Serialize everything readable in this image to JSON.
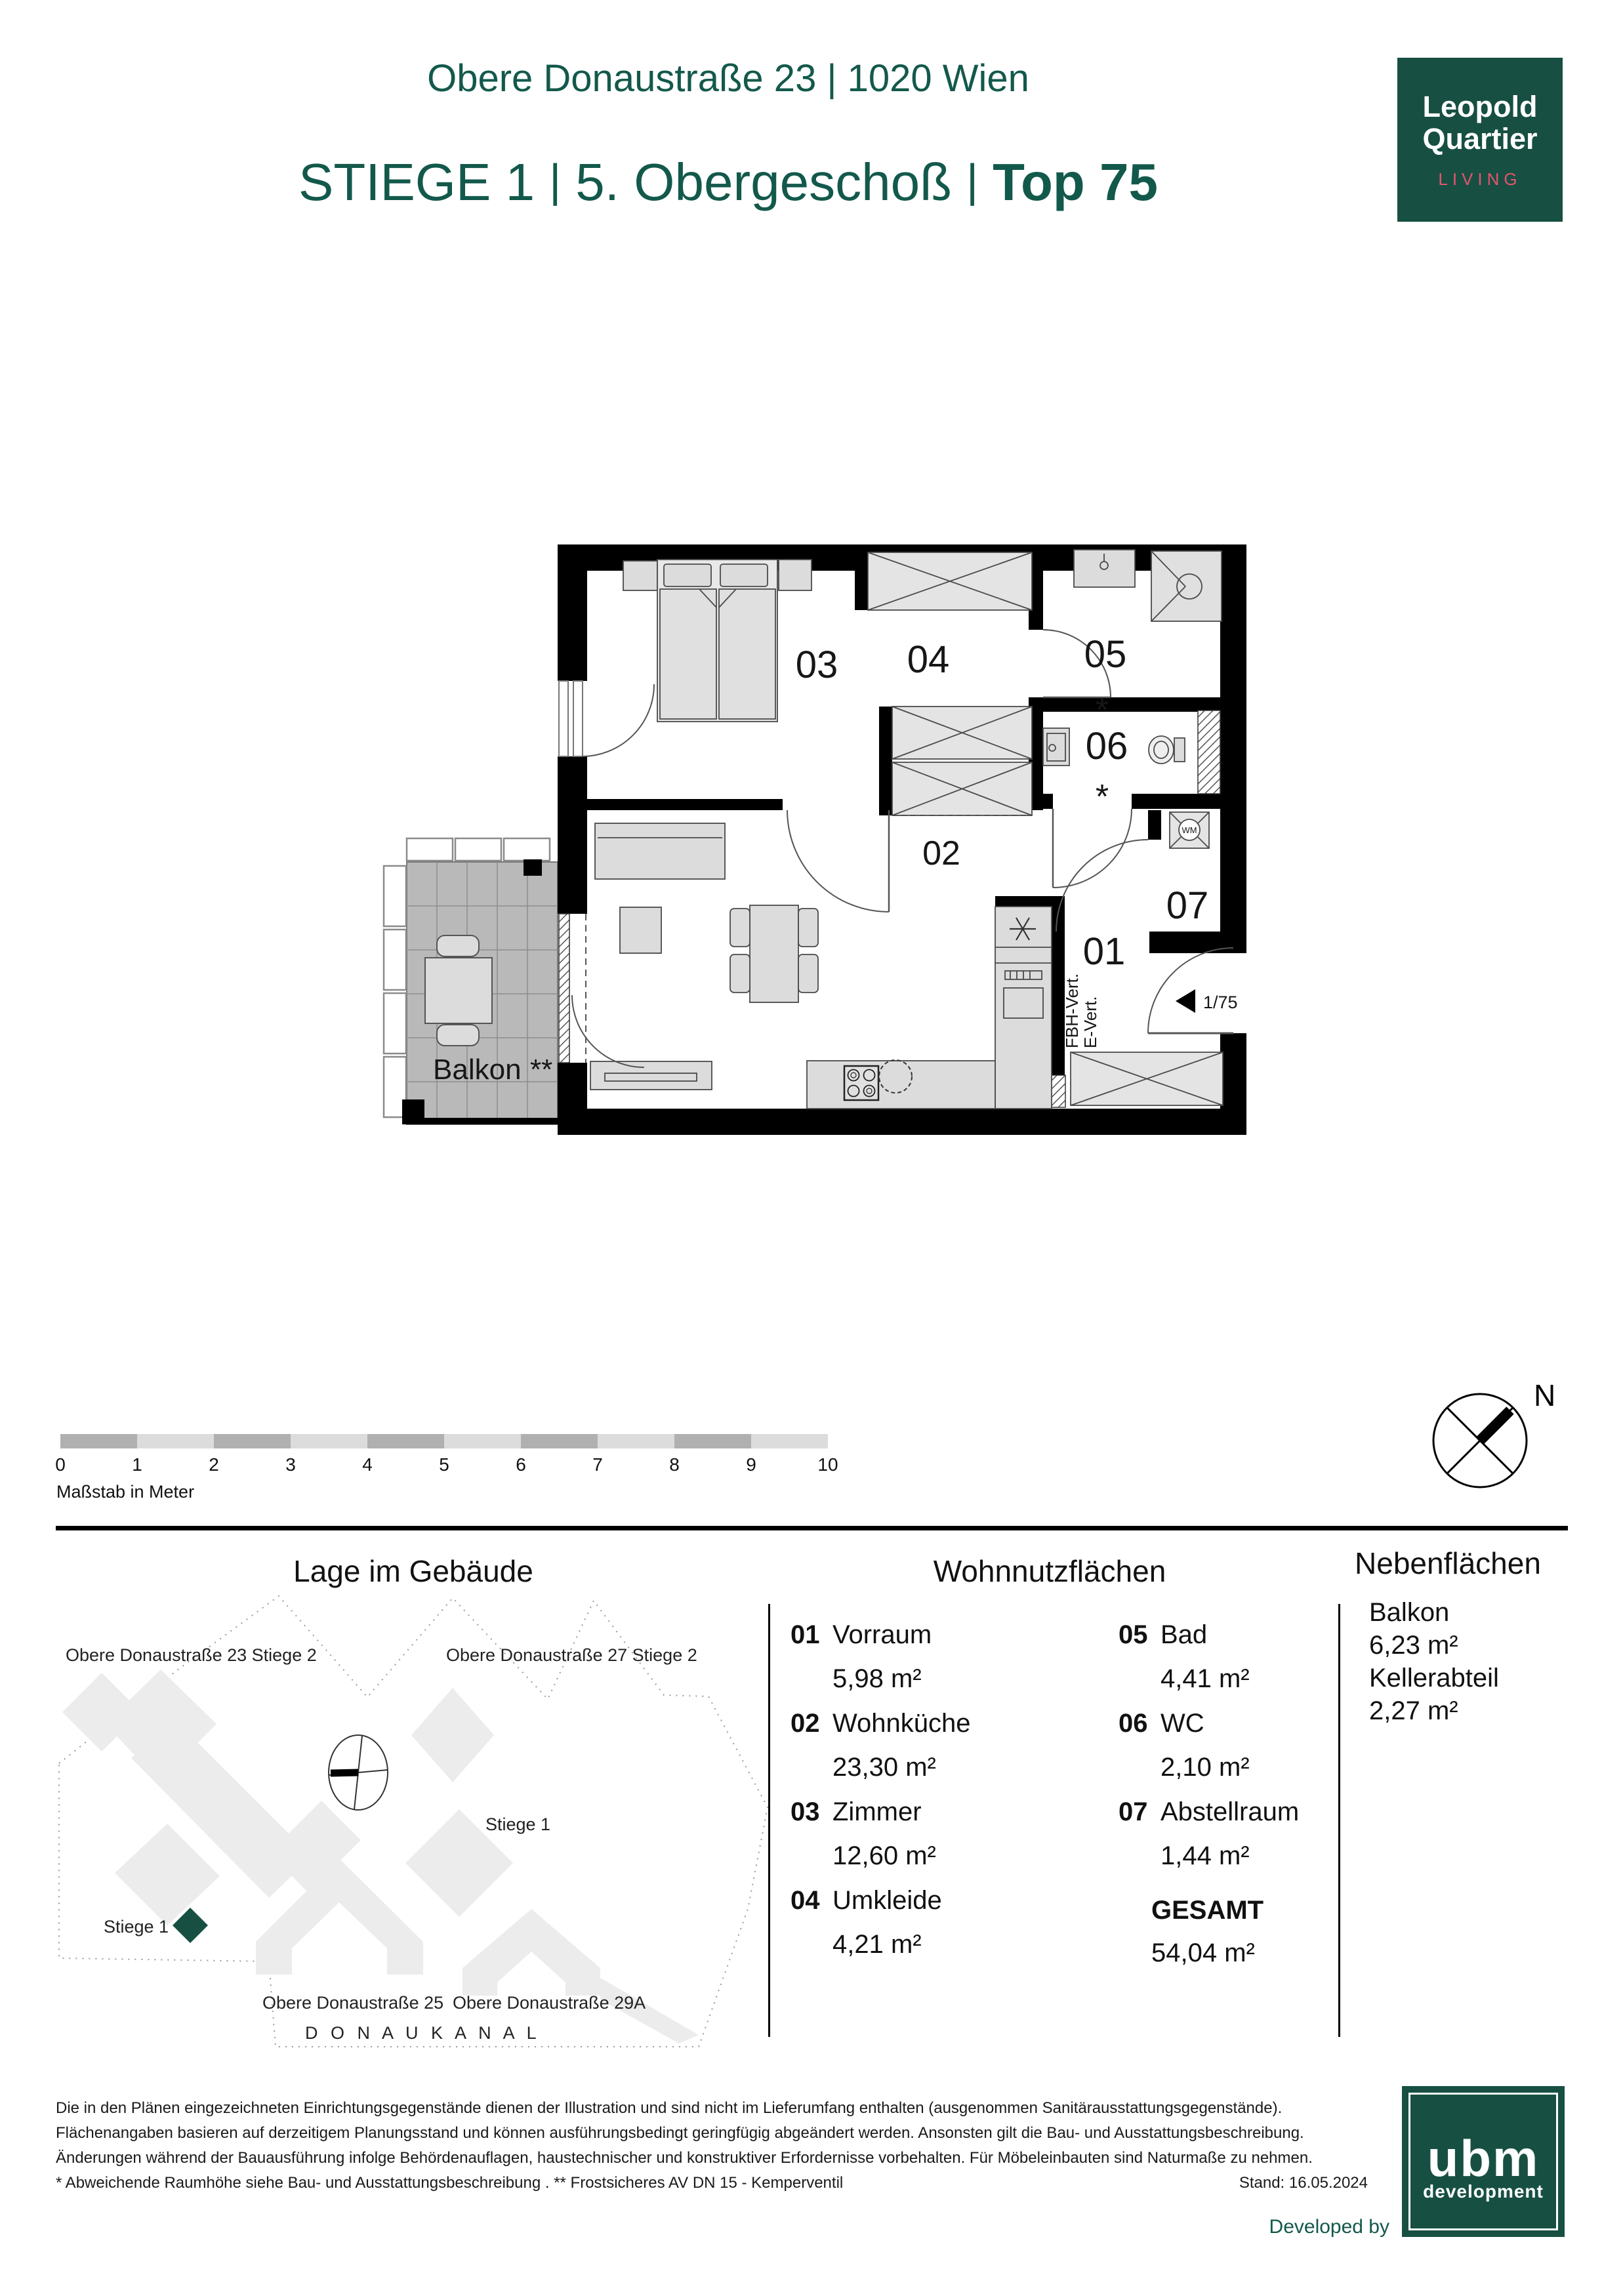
{
  "header": {
    "address": "Obere Donaustraße 23 | 1020 Wien",
    "stiege": "STIEGE 1",
    "sep": "|",
    "floor": "5. Obergeschoß",
    "top": "Top 75"
  },
  "brand": {
    "line1": "Leopold",
    "line2": "Quartier",
    "line3": "LIVING"
  },
  "floor_plan": {
    "rooms": {
      "r01": "01",
      "r02": "02",
      "r03": "03",
      "r04": "04",
      "r05": "05",
      "r06": "06",
      "r07": "07"
    },
    "star": "*",
    "balkon": "Balkon",
    "balkon_note": "**",
    "wm": "WM",
    "fbh": "FBH-Vert.",
    "evert": "E-Vert.",
    "entry_door": "1/75"
  },
  "scalebar": {
    "ticks": [
      "0",
      "1",
      "2",
      "3",
      "4",
      "5",
      "6",
      "7",
      "8",
      "9",
      "10"
    ],
    "label": "Maßstab in Meter"
  },
  "compass": {
    "north": "N"
  },
  "site_plan": {
    "title": "Lage im Gebäude",
    "labels": {
      "b23": "Obere Donaustraße 23 Stiege 2",
      "b27": "Obere Donaustraße 27 Stiege 2",
      "stiege1_right": "Stiege 1",
      "stiege1_left": "Stiege 1",
      "b25": "Obere Donaustraße 25",
      "b29a": "Obere Donaustraße 29A",
      "kanal": "D O N A U K A N A L"
    }
  },
  "wohnnutzflaechen": {
    "title": "Wohnnutzflächen",
    "items": [
      {
        "num": "01",
        "name": "Vorraum",
        "area": "5,98 m²"
      },
      {
        "num": "02",
        "name": "Wohnküche",
        "area": "23,30 m²"
      },
      {
        "num": "03",
        "name": "Zimmer",
        "area": "12,60 m²"
      },
      {
        "num": "04",
        "name": "Umkleide",
        "area": "4,21 m²"
      },
      {
        "num": "05",
        "name": "Bad",
        "area": "4,41 m²"
      },
      {
        "num": "06",
        "name": "WC",
        "area": "2,10 m²"
      },
      {
        "num": "07",
        "name": "Abstellraum",
        "area": "1,44 m²"
      }
    ],
    "total_label": "GESAMT",
    "total_value": "54,04 m²"
  },
  "nebenflaechen": {
    "title": "Nebenflächen",
    "items": [
      {
        "name": "Balkon",
        "area": "6,23 m²"
      },
      {
        "name": "Kellerabteil",
        "area": "2,27 m²"
      }
    ]
  },
  "footer": {
    "line1": "Die in den Plänen eingezeichneten Einrichtungsgegenstände dienen der Illustration und sind nicht im Lieferumfang enthalten (ausgenommen Sanitärausstattungsgegenstände).",
    "line2": "Flächenangaben basieren auf derzeitigem Planungsstand und können ausführungsbedingt geringfügig abgeändert werden. Ansonsten gilt die Bau- und Ausstattungsbeschreibung.",
    "line3": "Änderungen während der Bauausführung infolge Behördenauflagen, haustechnischer und konstruktiver Erfordernisse vorbehalten. Für Möbeleinbauten sind Naturmaße zu nehmen.",
    "line4": "* Abweichende Raumhöhe siehe Bau- und Ausstattungsbeschreibung . ** Frostsicheres AV DN 15 - Kemperventil",
    "stand": "Stand: 16.05.2024",
    "developed_by": "Developed by",
    "ubm_name": "ubm",
    "ubm_sub": "development"
  },
  "colors": {
    "brand_green": "#13594b",
    "logo_bg": "#174f43",
    "living_pink": "#e2566c",
    "marker_green": "#175043",
    "wall_black": "#000000",
    "furniture_gray": "#dcdcdc",
    "balcony_tile_gray": "#b9b9b9"
  }
}
